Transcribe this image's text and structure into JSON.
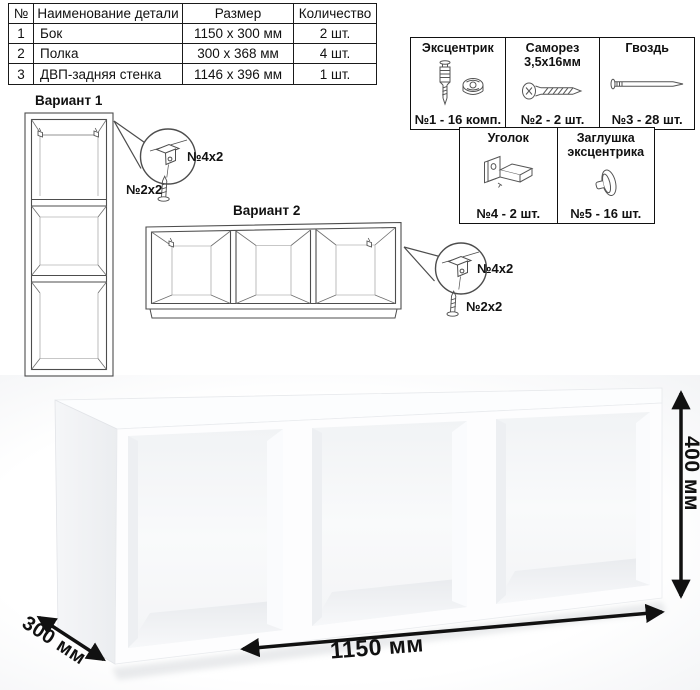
{
  "parts_table": {
    "headers": [
      "№",
      "Наименование детали",
      "Размер",
      "Количество"
    ],
    "rows": [
      [
        "1",
        "Бок",
        "1150 х 300 мм",
        "2 шт."
      ],
      [
        "2",
        "Полка",
        "300 х 368 мм",
        "4 шт."
      ],
      [
        "3",
        "ДВП-задняя стенка",
        "1146 х 396 мм",
        "1 шт."
      ]
    ]
  },
  "hardware": {
    "items": [
      {
        "title": "Эксцентрик",
        "caption": "№1 - 16 комп.",
        "icon": "eccentric-cam-icon"
      },
      {
        "title": "Саморез 3,5х16мм",
        "caption": "№2 - 2 шт.",
        "icon": "screw-icon"
      },
      {
        "title": "Гвоздь",
        "caption": "№3 - 28 шт.",
        "icon": "nail-icon"
      },
      {
        "title": "Уголок",
        "caption": "№4 - 2 шт.",
        "icon": "corner-bracket-icon"
      },
      {
        "title": "Заглушка эксцентрика",
        "caption": "№5 - 16 шт.",
        "icon": "cam-cap-icon"
      }
    ]
  },
  "variants": {
    "variant1": {
      "label": "Вариант 1",
      "bracket_label": "№4х2",
      "screw_label": "№2х2"
    },
    "variant2": {
      "label": "Вариант 2",
      "bracket_label": "№4х2",
      "screw_label": "№2х2"
    }
  },
  "dimensions": {
    "width": "1150 мм",
    "height": "400 мм",
    "depth": "300 мм"
  },
  "colors": {
    "drawing_line": "#4d4d4d",
    "text": "#111111",
    "arrow": "#111111"
  }
}
